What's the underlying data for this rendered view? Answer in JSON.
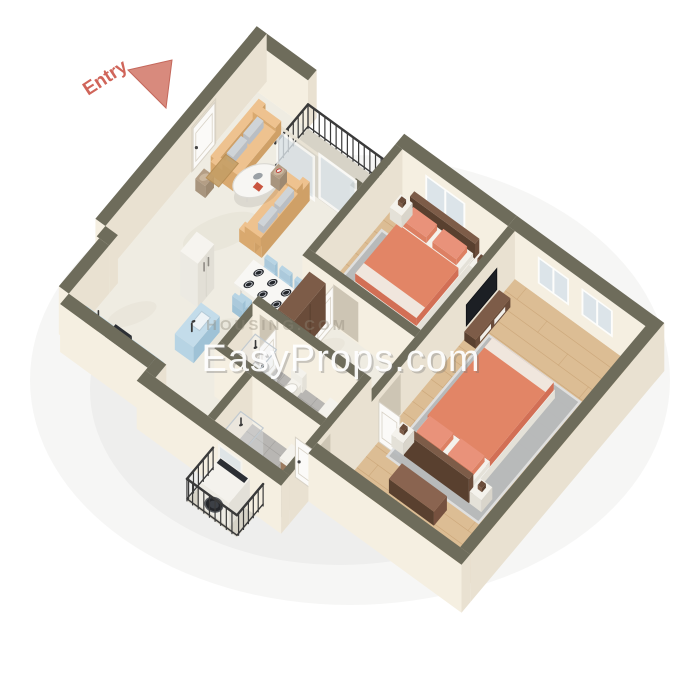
{
  "labels": {
    "entry": "Entry"
  },
  "watermark": {
    "primary": "EasyProps.com",
    "secondary": "HOUSING.COM"
  },
  "palette": {
    "background": "#ffffff",
    "wall_top": "#6e6c5b",
    "wall_light": "#f5efe1",
    "wall_mid": "#e9e1d1",
    "floor_marble": "#efece2",
    "marble_vein": "#e3dfd2",
    "floor_wood": "#dcbd94",
    "wood_line": "#c7a173",
    "floor_tile": "#b8b6b3",
    "tile_line": "#a09e9b",
    "concrete": "#d7d3c7",
    "rug": "#b7babd",
    "rug_edge": "#e0e1e2",
    "railing": "#3a3a3a",
    "glass": "#dce4e9",
    "frame_white": "#fdfdfb",
    "coral": "#e28566",
    "coral_side": "#d26f55",
    "coral_pillow": "#e9927a",
    "coral_pillow_side": "#dd8063",
    "white_top": "#f4f2ec",
    "white_side": "#e4e1d8",
    "sofa_top": "#eec28f",
    "sofa_side": "#d9a96f",
    "sofa_end": "#cfa067",
    "cushion": "#cfd4d8",
    "cushion_side": "#b9bec4",
    "chair_blue": "#b7d4e4",
    "chair_blue_side": "#9fc2d6",
    "counter_blue_top": "#c3dcea",
    "brown": "#7d5c48",
    "brown_side": "#6a4c3a",
    "brown_dark": "#59402f",
    "bench": "#8a6450",
    "bench_side": "#76513f",
    "dark": "#2c2f34",
    "tv_black": "#1c1f24",
    "door_white": "#fbfaf8",
    "door_edge": "#d8d2c6",
    "recess": "#cdc5b4",
    "mat": "#c59f66",
    "sink_brown": "#a98868",
    "plate": "#23262b",
    "plate_rim": "#c8cbd0",
    "stool": "#b49e85",
    "stool_top": "#cbb79e",
    "shadow": "#6b675c",
    "entry_red": "#d0655a",
    "entry_arrow": "#d88a7d",
    "entry_arrow_edge": "#c4685c",
    "wm_shadow": "#777777",
    "wm_faint": "#8f8878"
  },
  "semantics": {
    "rooms": [
      "living-room",
      "dining-area",
      "kitchen",
      "hallway",
      "bedroom-1",
      "bedroom-2",
      "bathroom-1",
      "bathroom-2",
      "balcony",
      "laundry-balcony"
    ]
  }
}
